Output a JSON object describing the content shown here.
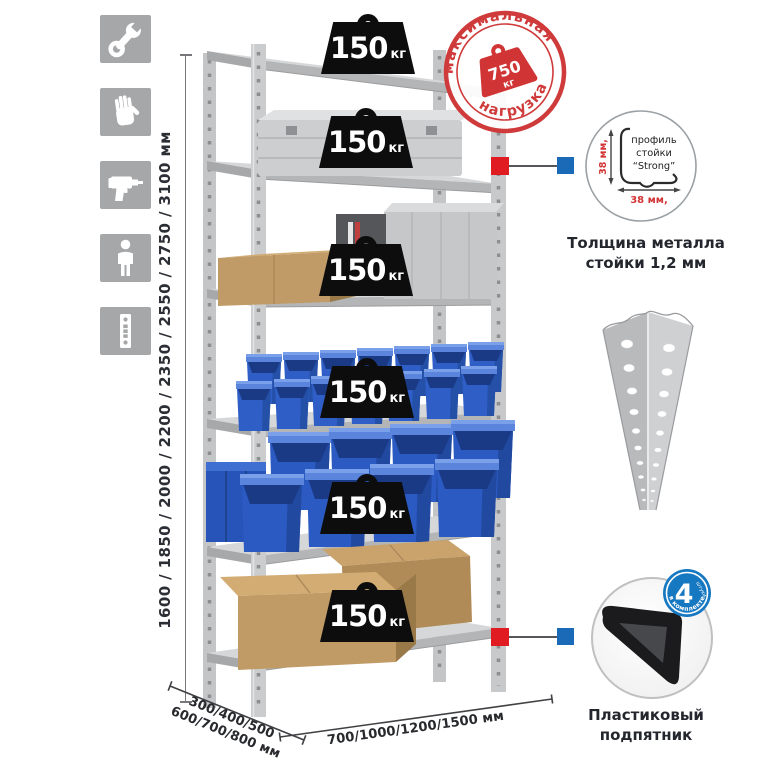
{
  "colors": {
    "stamp_red": "#cf3a3a",
    "marker_red": "#e01b22",
    "marker_blue": "#1a6ab8",
    "badge_blue": "#1778c2",
    "bin_blue": "#2e5ec6",
    "steel_grey": "#c7c8ca",
    "icon_grey": "#a6a7a9",
    "cardboard": "#bf9a67"
  },
  "left_icons": [
    "wrench-icon",
    "gloves-icon",
    "drill-icon",
    "person-icon",
    "rack-profile-icon"
  ],
  "height_dim": {
    "label": "1600 / 1850 / 2000 / 2200 / 2350 / 2550 / 2750 / 3100 мм"
  },
  "rack": {
    "weights": [
      {
        "value": "150",
        "unit": "кг"
      },
      {
        "value": "150",
        "unit": "кг"
      },
      {
        "value": "150",
        "unit": "кг"
      },
      {
        "value": "150",
        "unit": "кг"
      },
      {
        "value": "150",
        "unit": "кг"
      },
      {
        "value": "150",
        "unit": "кг"
      }
    ]
  },
  "stamp": {
    "arc_top": "максимальная",
    "arc_bottom": "нагрузка",
    "weight_value": "750",
    "weight_unit": "кг"
  },
  "profile_detail": {
    "line1": "профиль",
    "line2": "стойки",
    "line3": "“Strong”",
    "dim_v": "38 мм,",
    "dim_h": "38 мм,",
    "caption1": "Толщина металла",
    "caption2": "стойки 1,2 мм"
  },
  "foot_detail": {
    "badge_number": "4",
    "badge_units": "штуки",
    "badge_arc": "в комплекте",
    "caption1": "Пластиковый",
    "caption2": "подпятник"
  },
  "floor_dims": {
    "depth_line1": "300/400/500",
    "depth_line2": "600/700/800 мм",
    "width_line": "700/1000/1200/1500 мм"
  }
}
